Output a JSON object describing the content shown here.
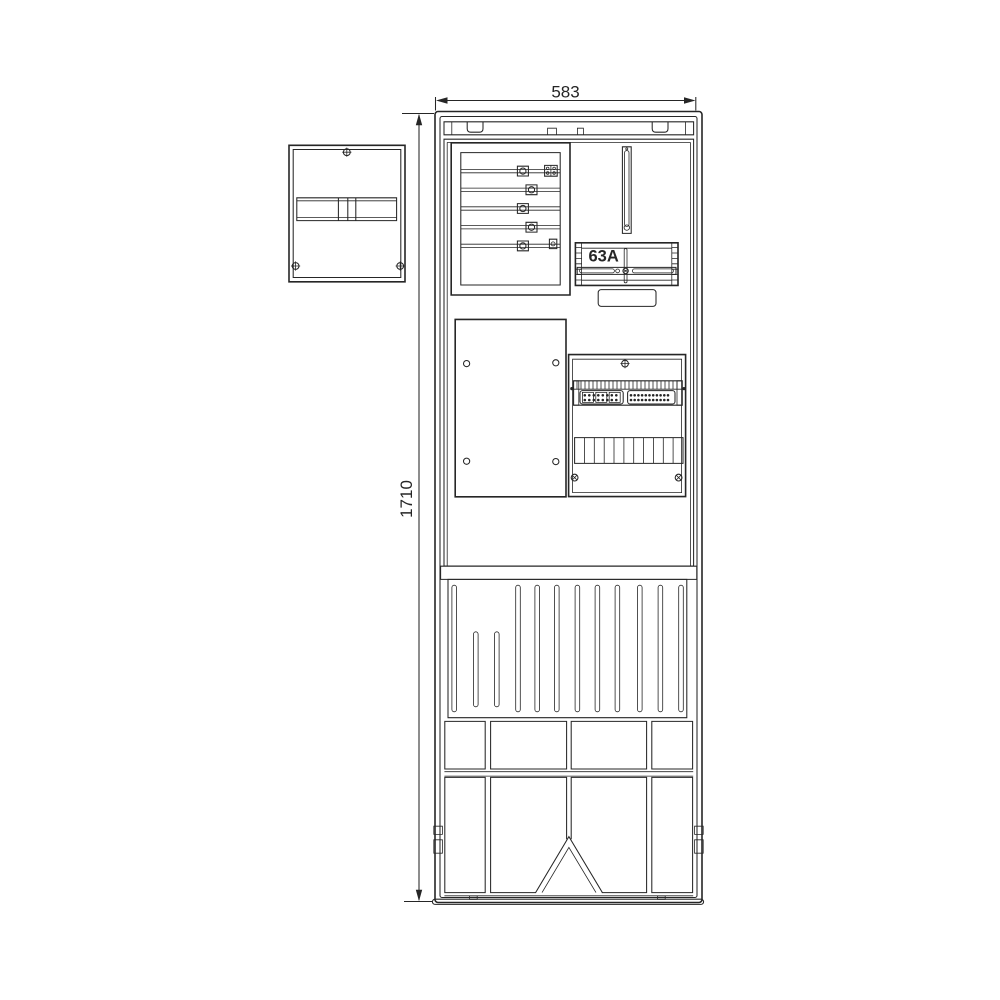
{
  "drawing": {
    "dimensions": {
      "width_label": "583",
      "height_label": "1710"
    },
    "labels": {
      "breaker_rating": "63A"
    },
    "colors": {
      "line": "#262626",
      "background": "#ffffff"
    }
  }
}
